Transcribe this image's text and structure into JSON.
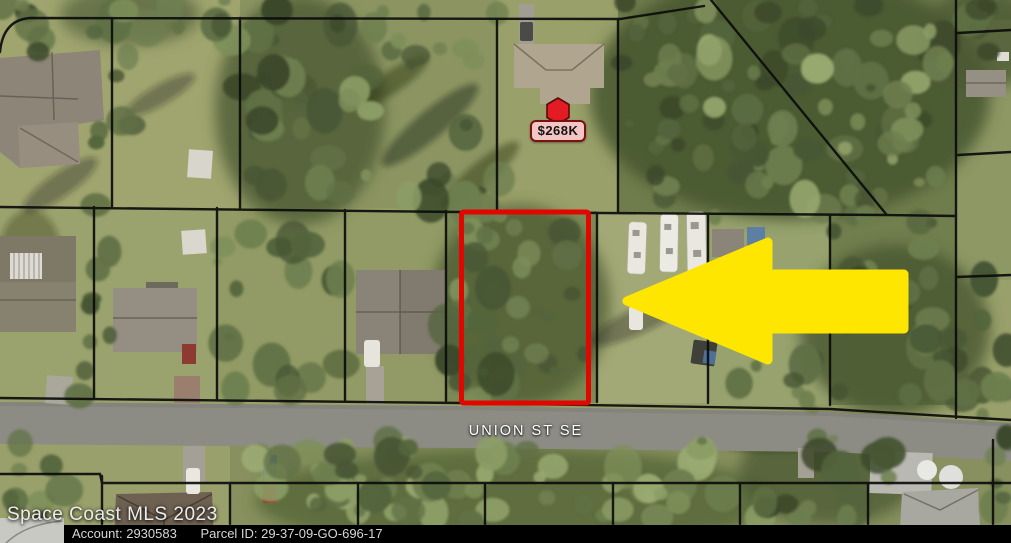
{
  "map": {
    "price_marker": {
      "value": "$268K",
      "pin_icon": "hexagon-pin"
    },
    "street_label": "UNION ST SE",
    "watermark": "Space Coast MLS 2023",
    "highlight_arrow_icon": "left-arrow",
    "subject_parcel_outline": "red-rectangle"
  },
  "footer": {
    "account_label": "Account:",
    "account_value": "2930583",
    "parcel_label": "Parcel ID:",
    "parcel_value": "29-37-09-GO-696-17"
  },
  "colors": {
    "parcel_outline": "#e10600",
    "arrow_fill": "#ffe600",
    "pin_fill": "#e31b23",
    "pin_border": "#5a0909",
    "bubble_bg": "#f4c5c5",
    "bubble_border": "#7a1111",
    "street_text": "#ffffff",
    "watermark_text": "#ebebe9",
    "footer_bg": "#000000",
    "footer_text": "#d6d6d6",
    "road": "#8c8c84"
  }
}
